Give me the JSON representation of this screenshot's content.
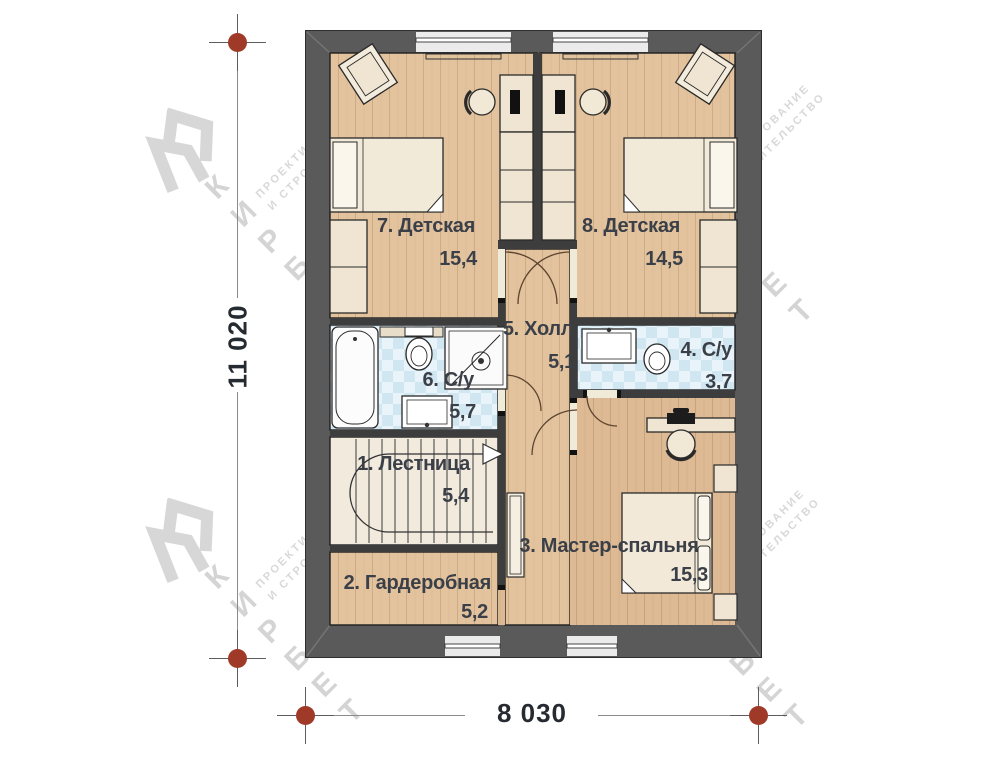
{
  "plan": {
    "title": "Floor plan, level 2",
    "rooms": [
      {
        "num": "7",
        "name": "7. Детская",
        "area": "15,4"
      },
      {
        "num": "8",
        "name": "8. Детская",
        "area": "14,5"
      },
      {
        "num": "5",
        "name": "5. Холл",
        "area": "5,1"
      },
      {
        "num": "6",
        "name": "6. С/у",
        "area": "5,7"
      },
      {
        "num": "4",
        "name": "4. С/у",
        "area": "3,7"
      },
      {
        "num": "1",
        "name": "1. Лестница",
        "area": "5,4"
      },
      {
        "num": "2",
        "name": "2. Гардеробная",
        "area": "5,2"
      },
      {
        "num": "3",
        "name": "3. Мастер-спальня",
        "area": "15,3"
      }
    ],
    "dimensions": {
      "height_mm": "11 020",
      "width_mm": "8 030"
    }
  },
  "watermark": {
    "brand": "КИРБЕТ",
    "tagline_line1": "ПРОЕКТИРОВАНИЕ",
    "tagline_line2": "И СТРОИТЕЛЬСТВО"
  },
  "colors": {
    "wall": "#5a5a5a",
    "wood_floor": "#e2c39e",
    "tile_floor": "#dceef6",
    "dimension_dot": "#a03a28",
    "label_text": "#3a3f48"
  }
}
